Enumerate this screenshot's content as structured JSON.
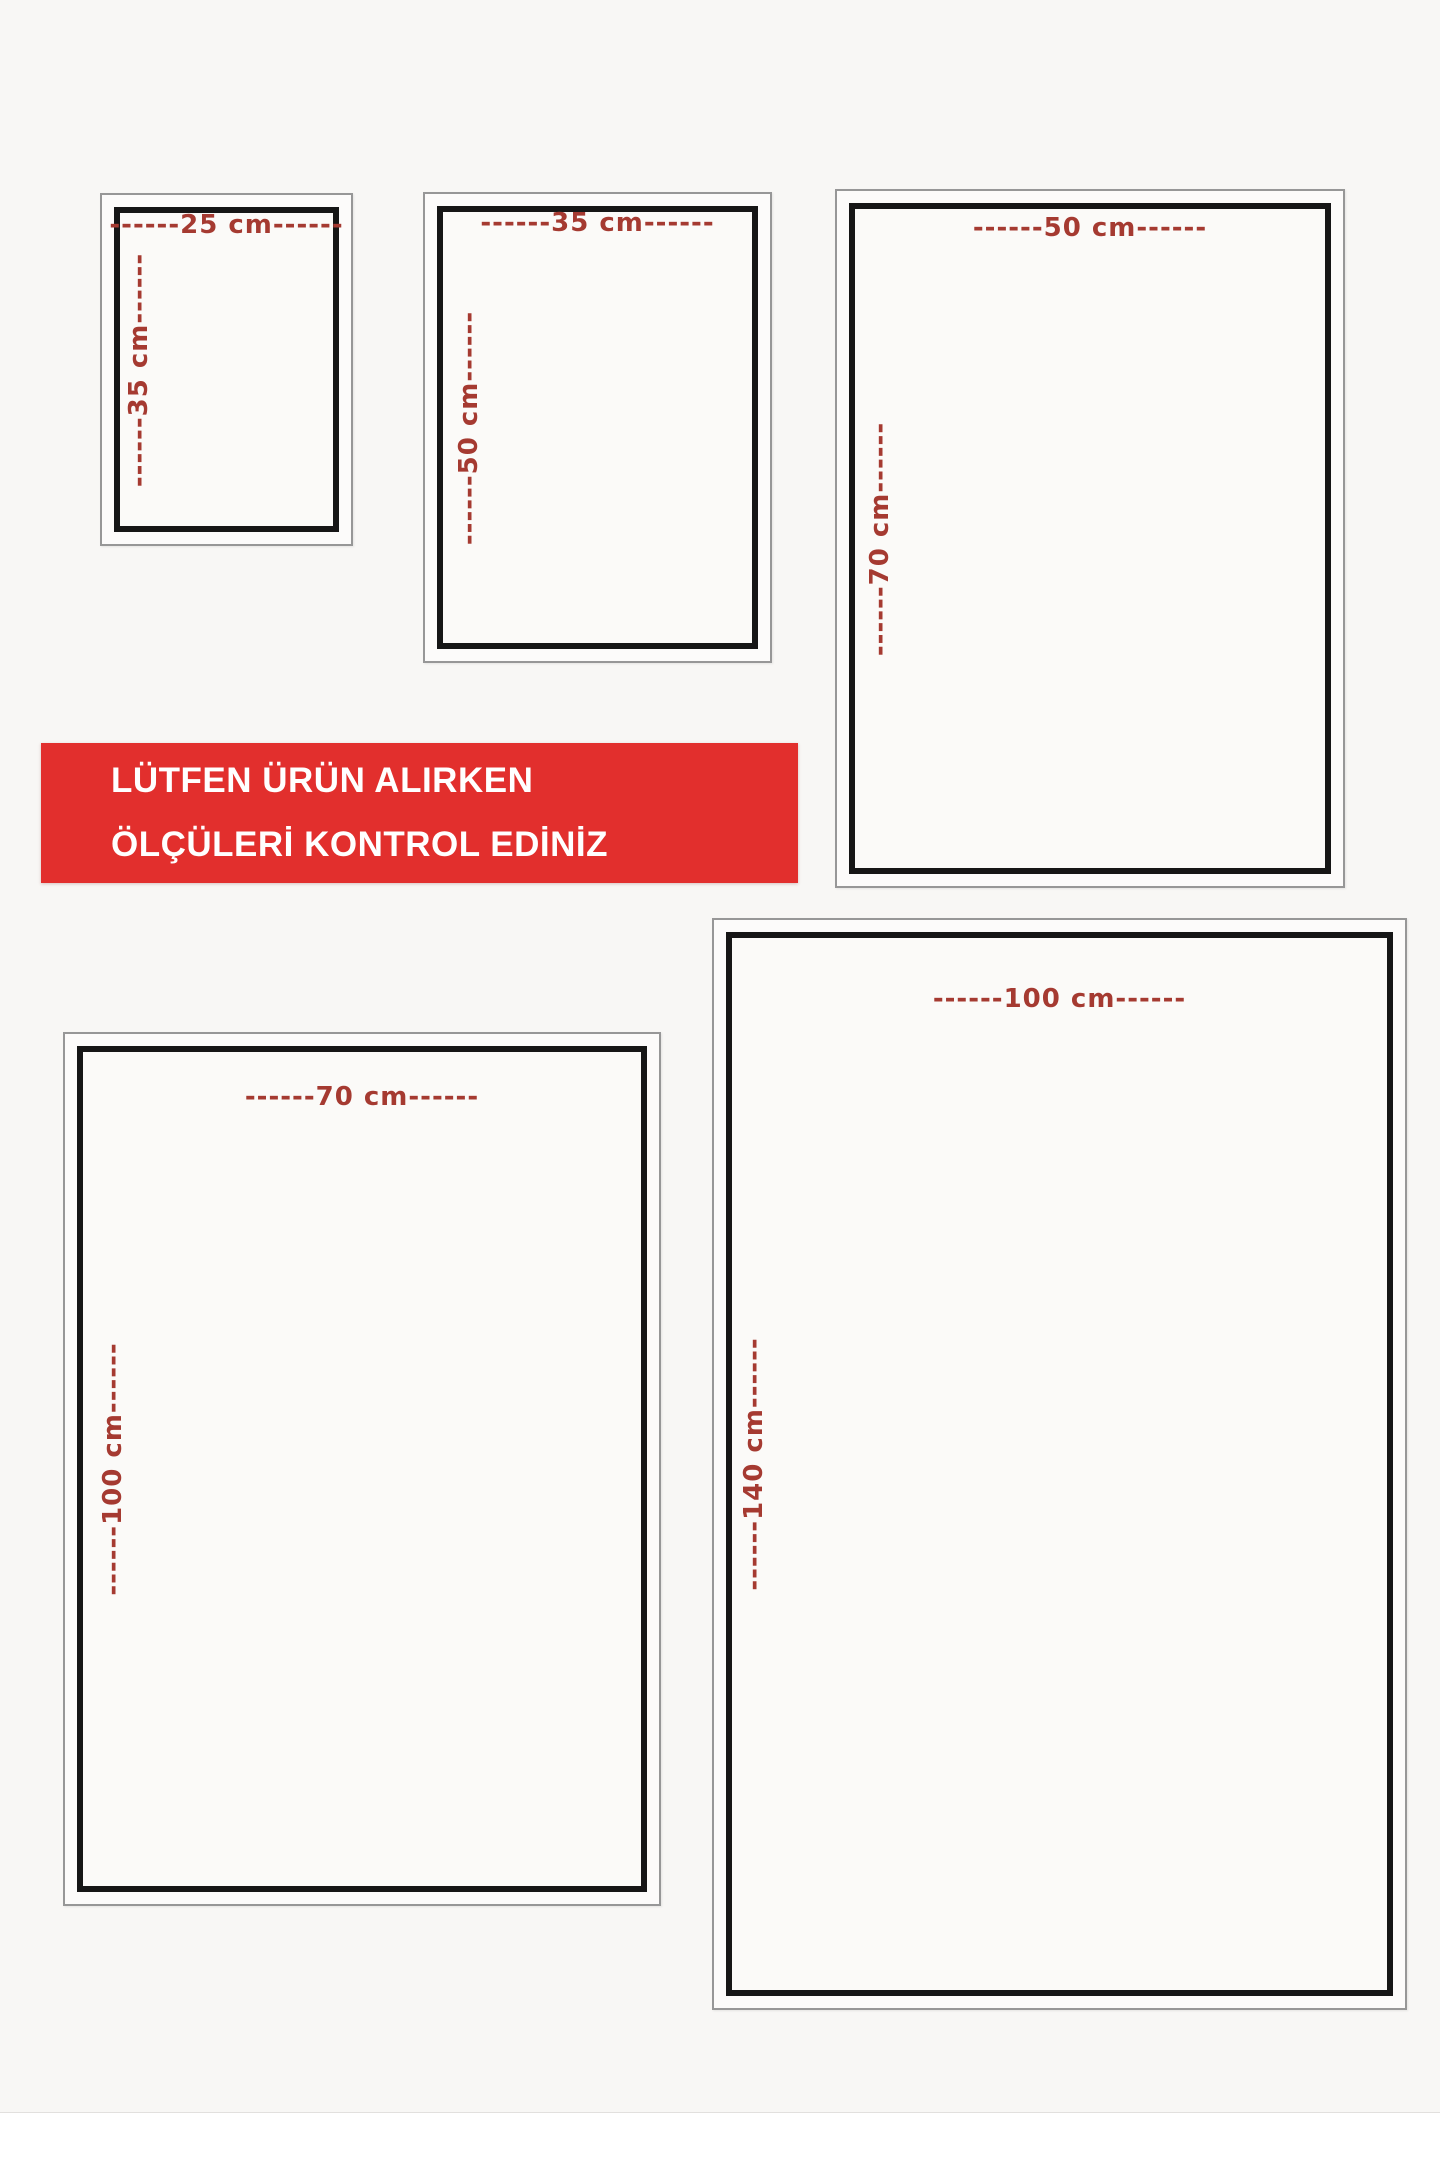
{
  "notice_banner": {
    "line1": "LÜTFEN ÜRÜN ALIRKEN",
    "line2": "ÖLÇÜLERİ KONTROL EDİNİZ",
    "background_color": "#e22f2d",
    "text_color": "#ffffff"
  },
  "dimension_label_color": "#a53a31",
  "size_boxes": [
    {
      "name": "25x35-cm",
      "width_cm": 25,
      "height_cm": 35,
      "top_label": "------25 cm------",
      "side_label": "------35 cm------"
    },
    {
      "name": "35x50-cm",
      "width_cm": 35,
      "height_cm": 50,
      "top_label": "------35 cm------",
      "side_label": "------50 cm------"
    },
    {
      "name": "50x70-cm",
      "width_cm": 50,
      "height_cm": 70,
      "top_label": "------50 cm------",
      "side_label": "------70 cm------"
    },
    {
      "name": "70x100-cm",
      "width_cm": 70,
      "height_cm": 100,
      "top_label": "------70 cm------",
      "side_label": "------100 cm------"
    },
    {
      "name": "100x140-cm",
      "width_cm": 100,
      "height_cm": 140,
      "top_label": "------100 cm------",
      "side_label": "------140 cm------"
    }
  ]
}
